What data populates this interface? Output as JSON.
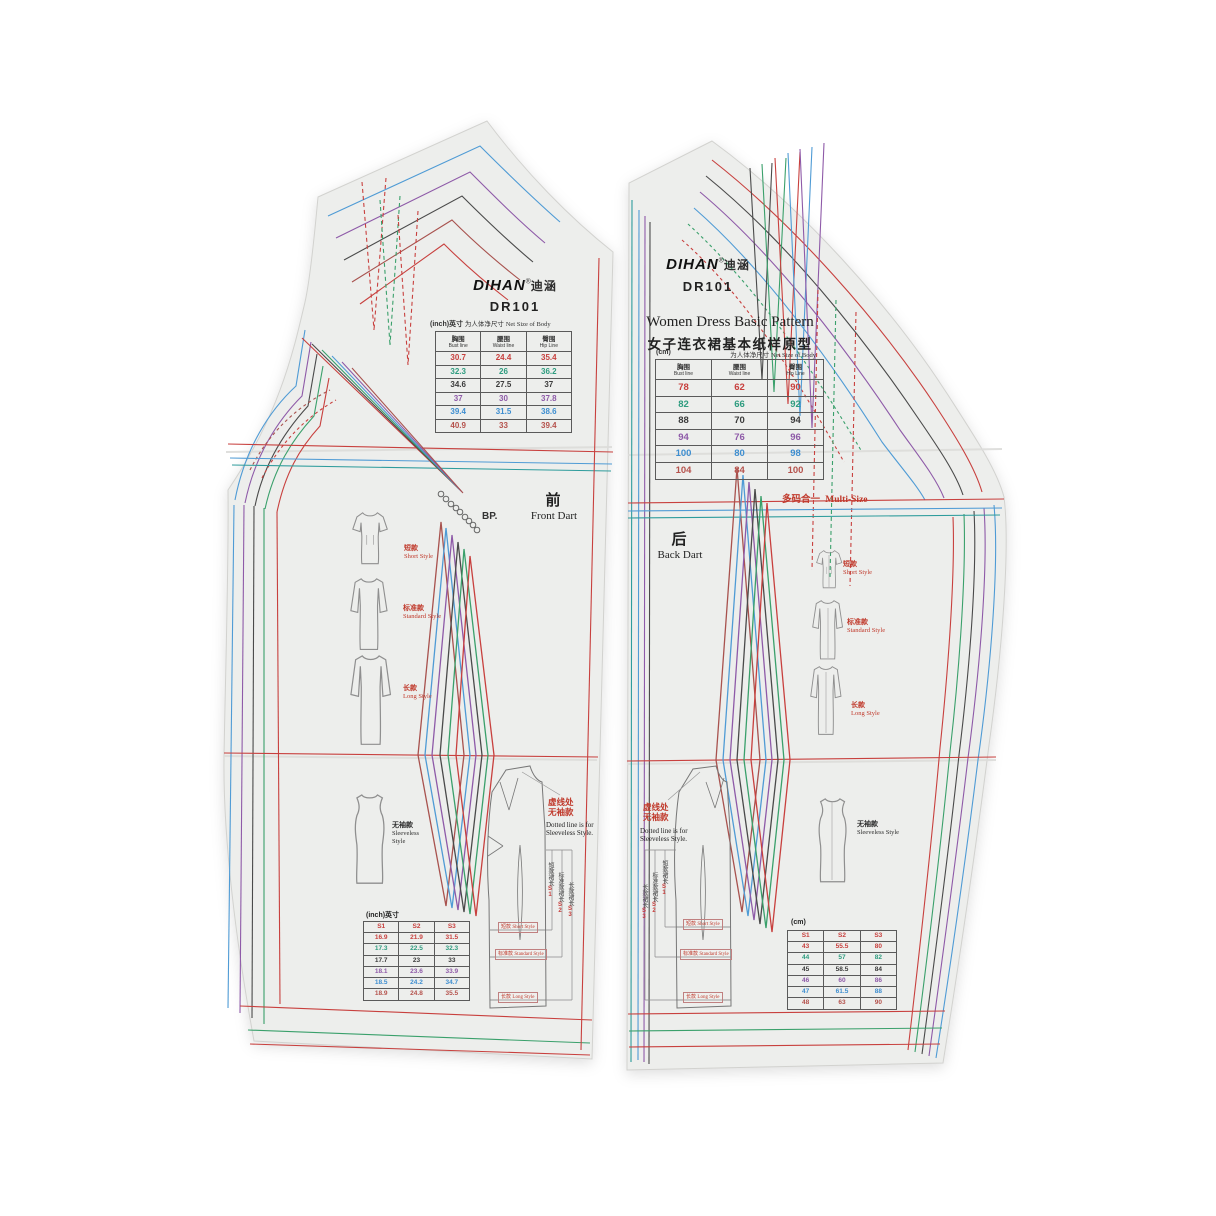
{
  "colors": {
    "paper": "#edeeec",
    "accent_red": "#c0392b",
    "size_palette": [
      "#c8403e",
      "#2e9c7f",
      "#3b3b3b",
      "#8e5aa8",
      "#3e8ed0",
      "#b5524c"
    ]
  },
  "left_panel": {
    "brand": "DIHAN",
    "brand_reg": "®",
    "brand_cn": "迪涵",
    "model": "DR101",
    "unit_label": "(inch)英寸",
    "net_size_cn": "为人体净尺寸",
    "net_size_en": "Net Size of Body",
    "measure_headers": [
      {
        "cn": "胸围",
        "en": "Bust line"
      },
      {
        "cn": "腰围",
        "en": "Waist line"
      },
      {
        "cn": "臀围",
        "en": "Hip Line"
      }
    ],
    "size_table_rows": [
      {
        "color": "#c8403e",
        "values": [
          "30.7",
          "24.4",
          "35.4"
        ]
      },
      {
        "color": "#2e9c7f",
        "values": [
          "32.3",
          "26",
          "36.2"
        ]
      },
      {
        "color": "#3b3b3b",
        "values": [
          "34.6",
          "27.5",
          "37"
        ]
      },
      {
        "color": "#8e5aa8",
        "values": [
          "37",
          "30",
          "37.8"
        ]
      },
      {
        "color": "#3e8ed0",
        "values": [
          "39.4",
          "31.5",
          "38.6"
        ]
      },
      {
        "color": "#b5524c",
        "values": [
          "40.9",
          "33",
          "39.4"
        ]
      }
    ],
    "bp_label": "BP.",
    "part_cn": "前",
    "part_en": "Front Dart",
    "style_short_cn": "短款",
    "style_short_en": "Short Style",
    "style_standard_cn": "标准款",
    "style_standard_en": "Standard Style",
    "style_long_cn": "长款",
    "style_long_en": "Long Style",
    "style_sleeveless_cn": "无袖款",
    "style_sleeveless_en": "Sleeveless Style",
    "dotted_note_cn1": "虚线处",
    "dotted_note_cn2": "无袖款",
    "dotted_note_en": "Dotted line is for Sleeveless Style.",
    "length_marks": [
      {
        "cn": "短款裙长",
        "code": "S1"
      },
      {
        "cn": "标准款裙长",
        "code": "S2"
      },
      {
        "cn": "长款裙长",
        "code": "S3"
      }
    ],
    "division_labels": [
      {
        "cn": "短款",
        "en": "Short Style"
      },
      {
        "cn": "标准款",
        "en": "Standard Style"
      },
      {
        "cn": "长款",
        "en": "Long Style"
      }
    ],
    "bottom_unit": "(inch)英寸",
    "bottom_headers": [
      "S1",
      "S2",
      "S3"
    ],
    "bottom_rows": [
      {
        "color": "#c8403e",
        "values": [
          "16.9",
          "21.9",
          "31.5"
        ]
      },
      {
        "color": "#2e9c7f",
        "values": [
          "17.3",
          "22.5",
          "32.3"
        ]
      },
      {
        "color": "#3b3b3b",
        "values": [
          "17.7",
          "23",
          "33"
        ]
      },
      {
        "color": "#8e5aa8",
        "values": [
          "18.1",
          "23.6",
          "33.9"
        ]
      },
      {
        "color": "#3e8ed0",
        "values": [
          "18.5",
          "24.2",
          "34.7"
        ]
      },
      {
        "color": "#b5524c",
        "values": [
          "18.9",
          "24.8",
          "35.5"
        ]
      }
    ]
  },
  "right_panel": {
    "brand": "DIHAN",
    "brand_reg": "®",
    "brand_cn": "迪涵",
    "model": "DR101",
    "title_en": "Women Dress  Basic Pattern",
    "title_cn": "女子连衣裙基本纸样原型",
    "unit_label": "(cm)",
    "net_size_cn": "为人体净尺寸",
    "net_size_en": "Net Size of Body",
    "measure_headers": [
      {
        "cn": "胸围",
        "en": "Bust line"
      },
      {
        "cn": "腰围",
        "en": "Waist line"
      },
      {
        "cn": "臀围",
        "en": "Hip Line"
      }
    ],
    "size_table_rows": [
      {
        "color": "#c8403e",
        "values": [
          "78",
          "62",
          "90"
        ]
      },
      {
        "color": "#2e9c7f",
        "values": [
          "82",
          "66",
          "92"
        ]
      },
      {
        "color": "#3b3b3b",
        "values": [
          "88",
          "70",
          "94"
        ]
      },
      {
        "color": "#8e5aa8",
        "values": [
          "94",
          "76",
          "96"
        ]
      },
      {
        "color": "#3e8ed0",
        "values": [
          "100",
          "80",
          "98"
        ]
      },
      {
        "color": "#b5524c",
        "values": [
          "104",
          "84",
          "100"
        ]
      }
    ],
    "multisize_cn": "多码合一",
    "multisize_en": "Multi-Size",
    "part_cn": "后",
    "part_en": "Back Dart",
    "style_short_cn": "短款",
    "style_short_en": "Short Style",
    "style_standard_cn": "标准款",
    "style_standard_en": "Standard Style",
    "style_long_cn": "长款",
    "style_long_en": "Long Style",
    "style_sleeveless_cn": "无袖款",
    "style_sleeveless_en": "Sleeveless Style",
    "dotted_note_cn1": "虚线处",
    "dotted_note_cn2": "无袖款",
    "dotted_note_en": "Dotted line is for Sleeveless Style.",
    "length_marks": [
      {
        "cn": "短款裙长",
        "code": "S1"
      },
      {
        "cn": "标准款裙长",
        "code": "S2"
      },
      {
        "cn": "长款裙长",
        "code": "S3"
      }
    ],
    "division_labels": [
      {
        "cn": "短款",
        "en": "Short Style"
      },
      {
        "cn": "标准款",
        "en": "Standard Style"
      },
      {
        "cn": "长款",
        "en": "Long Style"
      }
    ],
    "bottom_unit": "(cm)",
    "bottom_headers": [
      "S1",
      "S2",
      "S3"
    ],
    "bottom_rows": [
      {
        "color": "#c8403e",
        "values": [
          "43",
          "55.5",
          "80"
        ]
      },
      {
        "color": "#2e9c7f",
        "values": [
          "44",
          "57",
          "82"
        ]
      },
      {
        "color": "#3b3b3b",
        "values": [
          "45",
          "58.5",
          "84"
        ]
      },
      {
        "color": "#8e5aa8",
        "values": [
          "46",
          "60",
          "86"
        ]
      },
      {
        "color": "#3e8ed0",
        "values": [
          "47",
          "61.5",
          "88"
        ]
      },
      {
        "color": "#b5524c",
        "values": [
          "48",
          "63",
          "90"
        ]
      }
    ]
  }
}
